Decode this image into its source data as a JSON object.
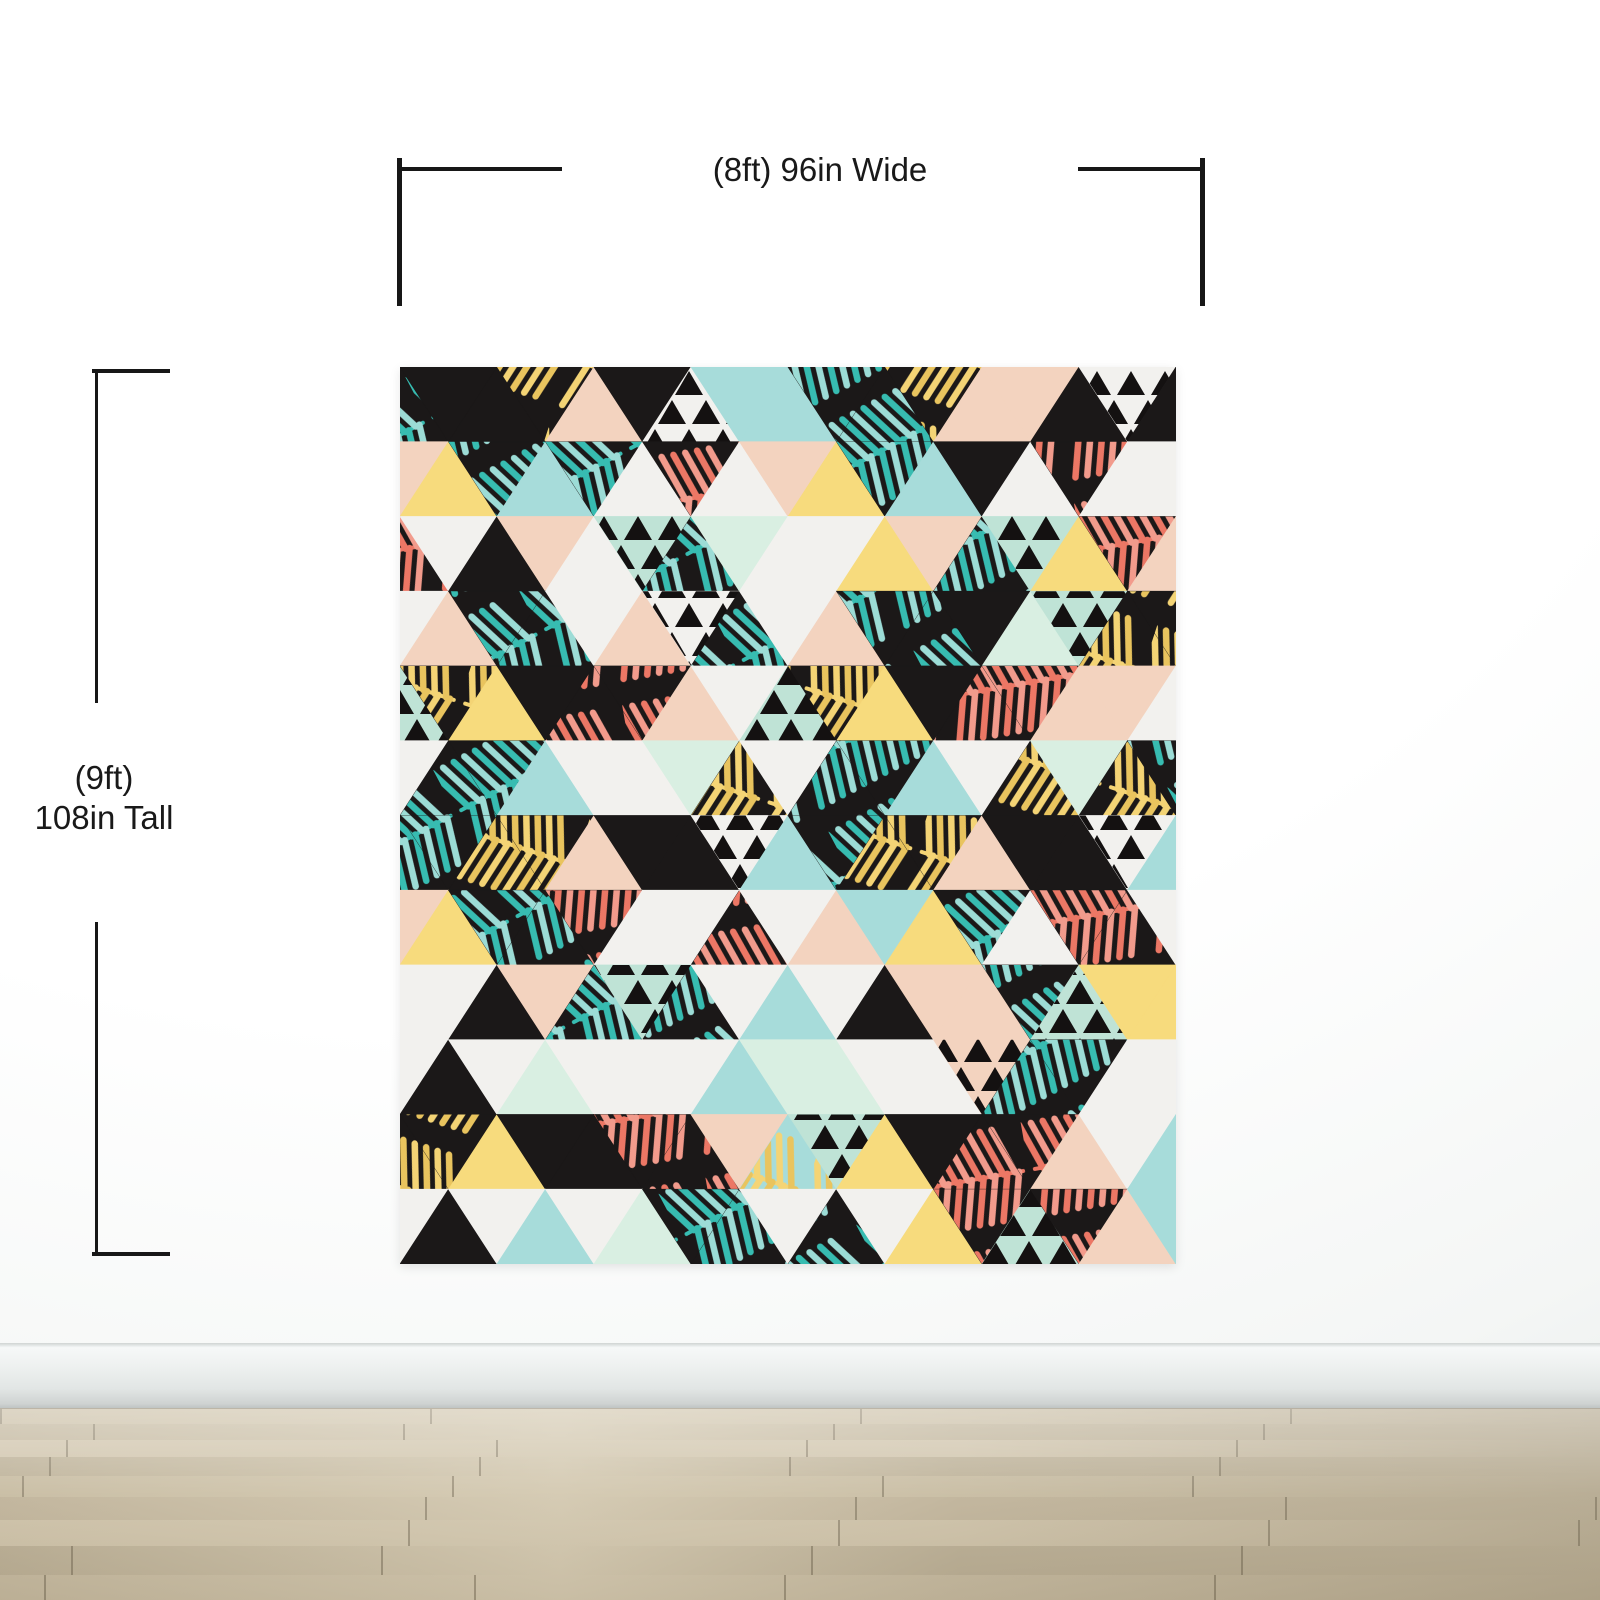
{
  "annotations": {
    "width_label": "(8ft) 96in Wide",
    "height_label_lines": [
      "(9ft)",
      "108in Tall"
    ],
    "line_color": "#171717",
    "text_color": "#191919"
  },
  "scene": {
    "wall_color": "#ffffff",
    "baseboard_color": "#e8eceb",
    "floor_base_color": "#c2b69c",
    "floor_plank_colors": [
      "#c9bda3",
      "#c0b49a",
      "#cfc3aa",
      "#bbaf95",
      "#c6ba9f",
      "#beb197",
      "#ccc0a6",
      "#b8ac92",
      "#c3b79d"
    ],
    "floor_seam_color": "rgba(85,75,55,0.4)"
  },
  "mural": {
    "description": "Tropical geometric triangle pattern wall mural with palm leaves",
    "palette": {
      "K": "#1b1818",
      "W": "#f2f1ee",
      "P": "#f3d3bf",
      "B": "#a7dcda",
      "M": "#d9efe2",
      "Y": "#f7db7d",
      "T": "#bfe3d6"
    },
    "palette_legend": {
      "K": "black",
      "W": "off-white",
      "P": "peach",
      "B": "light-blue",
      "M": "mint",
      "Y": "yellow",
      "T": "aqua"
    },
    "texture_legend": {
      "t": "teal-palm-leaves",
      "y": "yellow-palm-leaves",
      "c": "coral-palm-leaves",
      "x": "small-black-triangles"
    },
    "texture_colors": {
      "t": [
        "#37bcb1",
        "#9cdcd6"
      ],
      "y": [
        "#f4d475",
        "#e9c45e"
      ],
      "c": [
        "#ec7765",
        "#f29b8c"
      ],
      "x": "#141111"
    },
    "grid": {
      "columns": 16,
      "rows": 12
    },
    "rows": [
      [
        "K/t",
        "K",
        "K",
        "K/y",
        "P",
        "K",
        "W/x",
        "B",
        "B",
        "K/t",
        "K/t",
        "K/y",
        "P",
        "P",
        "K",
        "W/x",
        "K"
      ],
      [
        "P",
        "Y",
        "K/t",
        "B",
        "K/t",
        "W",
        "K/c",
        "W",
        "P",
        "Y",
        "K/t",
        "B",
        "K",
        "W",
        "K/c",
        "W",
        "W"
      ],
      [
        "K/c",
        "W",
        "K",
        "P",
        "W",
        "T/x",
        "K/t",
        "M",
        "W",
        "W",
        "Y",
        "P",
        "K/t",
        "T/x",
        "Y",
        "K/c",
        "P"
      ],
      [
        "W",
        "P",
        "K/t",
        "K/t",
        "W",
        "P",
        "W/x",
        "K/t",
        "W",
        "P",
        "K/t",
        "K/t",
        "K",
        "M",
        "T/x",
        "K/y",
        "K/y"
      ],
      [
        "T/x",
        "K/y",
        "Y",
        "K",
        "K/c",
        "K/c",
        "P",
        "W",
        "T/x",
        "K/y",
        "Y",
        "K",
        "K/c",
        "K/c",
        "P",
        "P",
        "W"
      ],
      [
        "W",
        "K/t",
        "K/t",
        "B",
        "W",
        "W",
        "M",
        "K/y",
        "W",
        "K/t",
        "K/t",
        "B",
        "W",
        "K/y",
        "M",
        "K/y",
        "K/t"
      ],
      [
        "K/t",
        "K/t",
        "K/y",
        "K/y",
        "P",
        "K",
        "K",
        "W/x",
        "B",
        "K/t",
        "K/y",
        "K/y",
        "P",
        "K",
        "K",
        "W/x",
        "B"
      ],
      [
        "P",
        "Y",
        "K/t",
        "K/t",
        "K/c",
        "W",
        "W",
        "K/c",
        "W",
        "P",
        "B",
        "Y",
        "K/t",
        "W",
        "K/c",
        "K/c",
        "W"
      ],
      [
        "W",
        "W",
        "K",
        "P",
        "K/t",
        "T/x",
        "K/t",
        "W",
        "B",
        "W",
        "K",
        "P",
        "P",
        "K/t",
        "T/x",
        "Y",
        "Y"
      ],
      [
        "W",
        "K",
        "W",
        "M",
        "W",
        "W",
        "W",
        "B",
        "M",
        "M",
        "W",
        "W",
        "P/x",
        "K/t",
        "K/t",
        "W",
        "W"
      ],
      [
        "K/y",
        "K/y",
        "Y",
        "K",
        "K",
        "K/c",
        "K/c",
        "P",
        "B/y",
        "T/x",
        "Y",
        "K",
        "K/c",
        "K/c",
        "P",
        "W",
        "B"
      ],
      [
        "W",
        "K",
        "W",
        "B",
        "W",
        "M",
        "K/t",
        "K/t",
        "W",
        "K/t",
        "W",
        "Y",
        "K/c",
        "T/x",
        "K/c",
        "P",
        "B"
      ]
    ]
  }
}
